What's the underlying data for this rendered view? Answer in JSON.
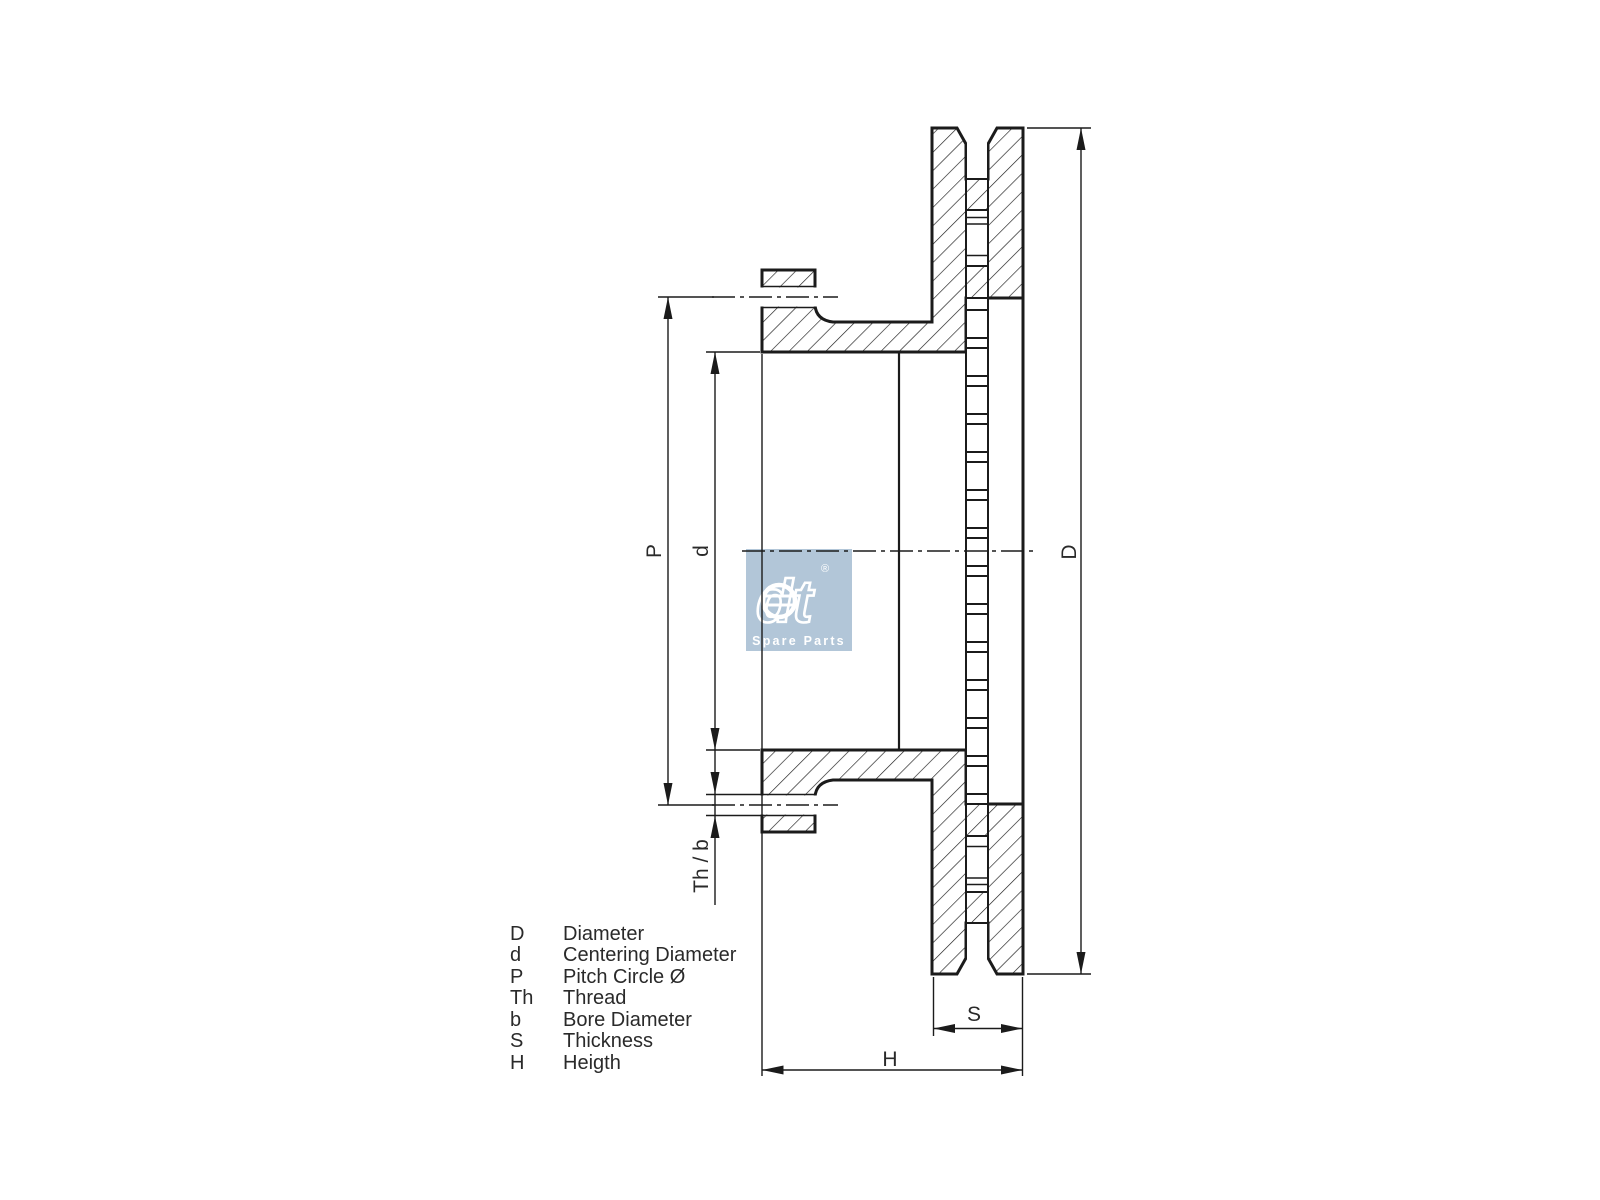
{
  "meta": {
    "background_color": "#ffffff",
    "line_color": "#1b1b1b",
    "text_color": "#2a2a2a"
  },
  "drawing": {
    "type": "brake-disc-cross-section",
    "dimension_labels": {
      "pitch_circle": "P",
      "centering_diameter": "d",
      "thread_bore": "Th / b",
      "diameter": "D",
      "thickness": "S",
      "height": "H"
    }
  },
  "legend": {
    "items": [
      {
        "symbol": "D",
        "description": "Diameter"
      },
      {
        "symbol": "d",
        "description": "Centering Diameter"
      },
      {
        "symbol": "P",
        "description": "Pitch Circle Ø"
      },
      {
        "symbol": "Th",
        "description": "Thread"
      },
      {
        "symbol": "b",
        "description": "Bore Diameter"
      },
      {
        "symbol": "S",
        "description": "Thickness"
      },
      {
        "symbol": "H",
        "description": "Heigth"
      }
    ]
  },
  "logo": {
    "brand": "dt",
    "registered": "®",
    "tagline": "Spare Parts",
    "bg_color": "#b2c6d8"
  }
}
